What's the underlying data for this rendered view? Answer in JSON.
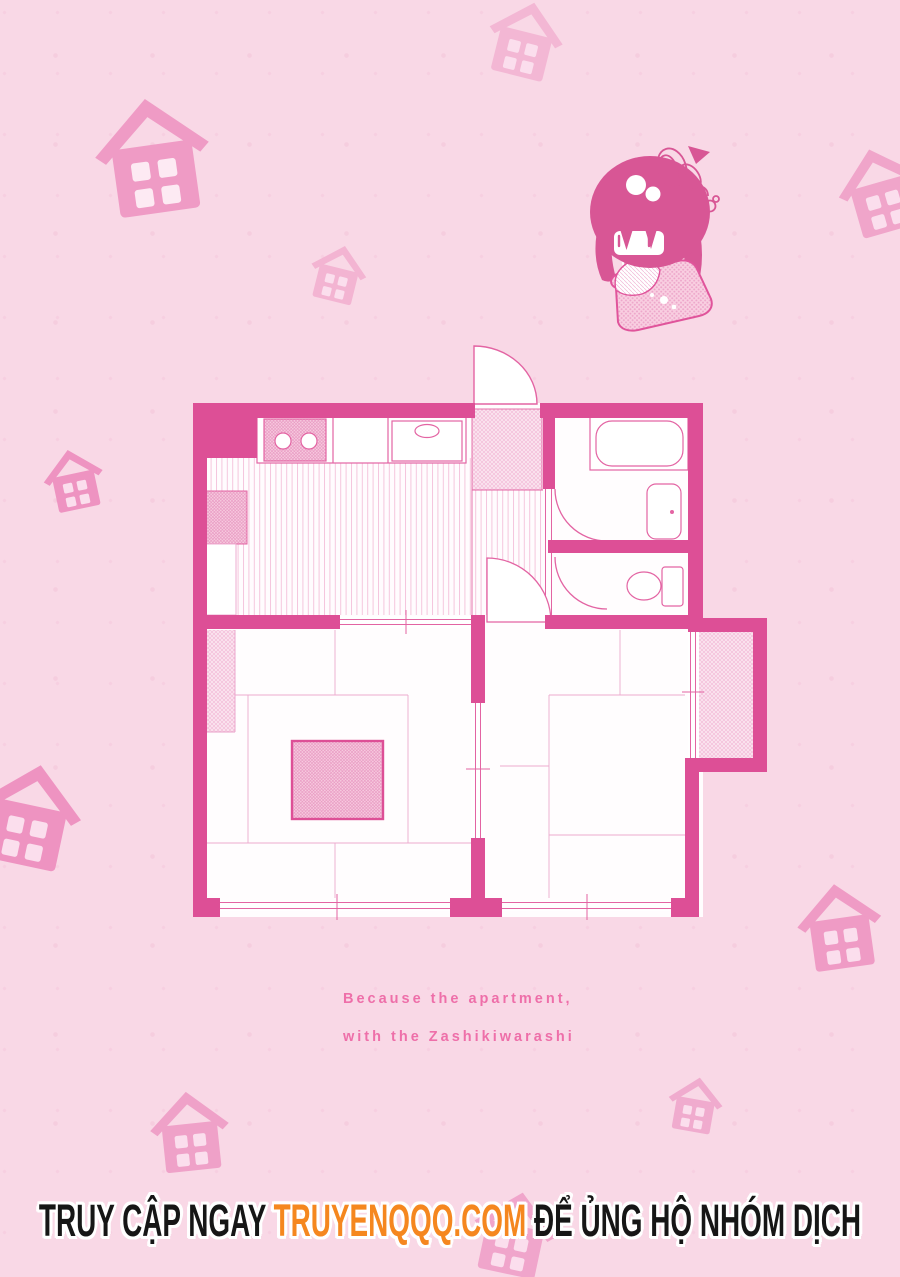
{
  "theme": {
    "bg": "#f9d8e6",
    "wall": "#dd4f96",
    "plan_line": "#e364a3",
    "grid_line": "#edaacf",
    "hair": "#d85695",
    "caption_color": "#ee6fa9",
    "footer_text_color": "#161616",
    "footer_site_color": "#f5871f",
    "house_window": "#fbdeed"
  },
  "caption": {
    "line1": "Because the apartment,",
    "line2": "with the Zashikiwarashi"
  },
  "footer": {
    "prefix": "TRUY CẬP NGAY ",
    "site": "TRUYENQQQ.COM",
    "suffix": " ĐỂ ỦNG HỘ NHÓM DỊCH"
  },
  "floor_plan": {
    "description": "one-bedroom Japanese apartment floor plan drawn in pink",
    "rooms": [
      "entrance-genkan",
      "kitchen-dining",
      "hallway",
      "bathroom",
      "toilet-room",
      "tatami-room-left",
      "tatami-room-right",
      "closet"
    ],
    "fixtures": [
      "two-burner-stove",
      "kitchen-sink",
      "refrigerator",
      "cabinet",
      "bathtub",
      "washbasin",
      "toilet",
      "kotatsu-table",
      "sliding-doors",
      "windows",
      "swing-doors"
    ]
  },
  "decorations": {
    "character": "chibi zashiki-warashi girl sitting on a cushion",
    "houses": [
      {
        "x": 485,
        "y": 0,
        "size": 80,
        "rot": 14,
        "color": "#f3b7d4"
      },
      {
        "x": 92,
        "y": 96,
        "size": 122,
        "rot": -8,
        "color": "#ef9bc5",
        "window": "#fdeaf3"
      },
      {
        "x": 308,
        "y": 244,
        "size": 60,
        "rot": 14,
        "color": "#f3b4d2"
      },
      {
        "x": 836,
        "y": 146,
        "size": 90,
        "rot": -16,
        "color": "#f0a5ca"
      },
      {
        "x": 42,
        "y": 448,
        "size": 64,
        "rot": -12,
        "color": "#ee93c1"
      },
      {
        "x": -24,
        "y": 762,
        "size": 108,
        "rot": 12,
        "color": "#ee93c1"
      },
      {
        "x": 795,
        "y": 882,
        "size": 90,
        "rot": -8,
        "color": "#ef9bc5"
      },
      {
        "x": 148,
        "y": 1090,
        "size": 84,
        "rot": -6,
        "color": "#efa1c8"
      },
      {
        "x": 666,
        "y": 1076,
        "size": 58,
        "rot": 10,
        "color": "#f0abce"
      },
      {
        "x": 470,
        "y": 1190,
        "size": 88,
        "rot": 12,
        "color": "#f0a5cb"
      }
    ]
  }
}
